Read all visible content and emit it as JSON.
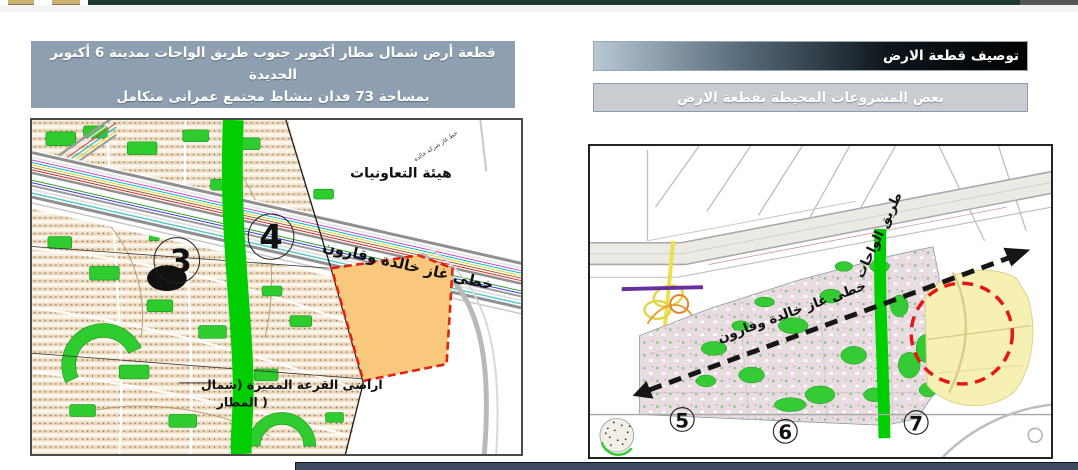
{
  "slide": {
    "title_box": {
      "line1": "قطعة أرض شمال مطار أكتوبر جنوب طريق الواحات بمدينة 6 أكتوبر الجديدة",
      "line2": "بمساحة 73 فدان بنشاط  مجتمع عمرانى متكامل"
    },
    "section_bar_primary": "توصيف قطعة الارض",
    "section_bar_secondary": "بعض المشروعات المحيطة بقطعة الارض"
  },
  "left_map": {
    "labels": {
      "cooperatives_authority": "هيئة التعاونيات",
      "gas_lines_big": "خطى غاز خالدة وقارون",
      "gas_line_small": "خط غاز شركة خالدة",
      "lottery_lands_line1": "اراضى القرعة المميزة (شمال",
      "lottery_lands_line2": "المطار )",
      "district_3": "3",
      "district_4": "4"
    }
  },
  "right_map": {
    "labels": {
      "oases_road": "طريق الواحات",
      "gas_lines": "خطى غاز خالدة وقارون",
      "district_5": "5",
      "district_6": "6",
      "district_7": "7"
    }
  },
  "colors": {
    "top_rule_green": "#1c3a31",
    "title_box_bg": "#8d9fb0",
    "primary_bar_dark": "#000000",
    "primary_bar_light": "#b9c7d3",
    "secondary_bar_bg": "#c9cdd2",
    "parcel_fill": "#f9c87d",
    "parcel_outline_red": "#e02211",
    "highlight_circle_red": "#e81414",
    "road_green": "#00ce00",
    "bottom_bar_navy": "#3b4a5f"
  }
}
